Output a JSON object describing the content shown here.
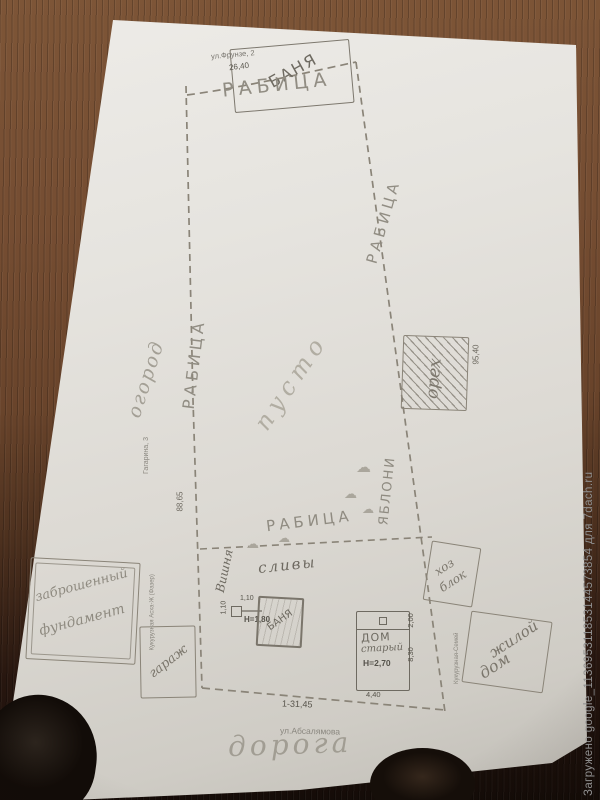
{
  "watermark": "Загружено google_113695311853144573854 для 7dach.ru",
  "plan": {
    "street_top": "ул.Фрунзе, 2",
    "shed_top": "БАНЯ",
    "dim_top": "26,40",
    "fence_top": "РАБИЦА",
    "fence_left": "РАБИЦА",
    "fence_right": "РАБИЦА",
    "fence_middle": "РАБИЦА",
    "dim_left": "88,65",
    "dim_right": "95,40",
    "dim_bottom": "1-31,45",
    "garden": "огород",
    "empty": "пусто",
    "apples": "ЯБЛОНИ",
    "walnut": "орех",
    "cherry": "Вишня",
    "plums": "сливы",
    "tree_glyph": "☁",
    "ruin_line1": "заброшенный",
    "ruin_line2": "фундамент",
    "garage": "гараж",
    "bath": "БАНЯ",
    "bath_height": "Н=1,80",
    "bath_dim_a": "1,10",
    "bath_dim_b": "1,10",
    "house_line1": "ДОМ",
    "house_line2": "старый",
    "house_height": "Н=2,70",
    "house_width": "4,40",
    "house_length": "8,30",
    "house_porch": "2,00",
    "hoz_line1": "хоз",
    "hoz_line2": "блок",
    "living_line1": "жилой",
    "living_line2": "дом",
    "street_bottom": "ул.Абсалямова",
    "road": "дорога",
    "print_gagarina": "Гагарина, 3",
    "print_left": "Кукурузная Асха-Ж (Фазер)",
    "print_right": "Кукурузная-Семей"
  }
}
